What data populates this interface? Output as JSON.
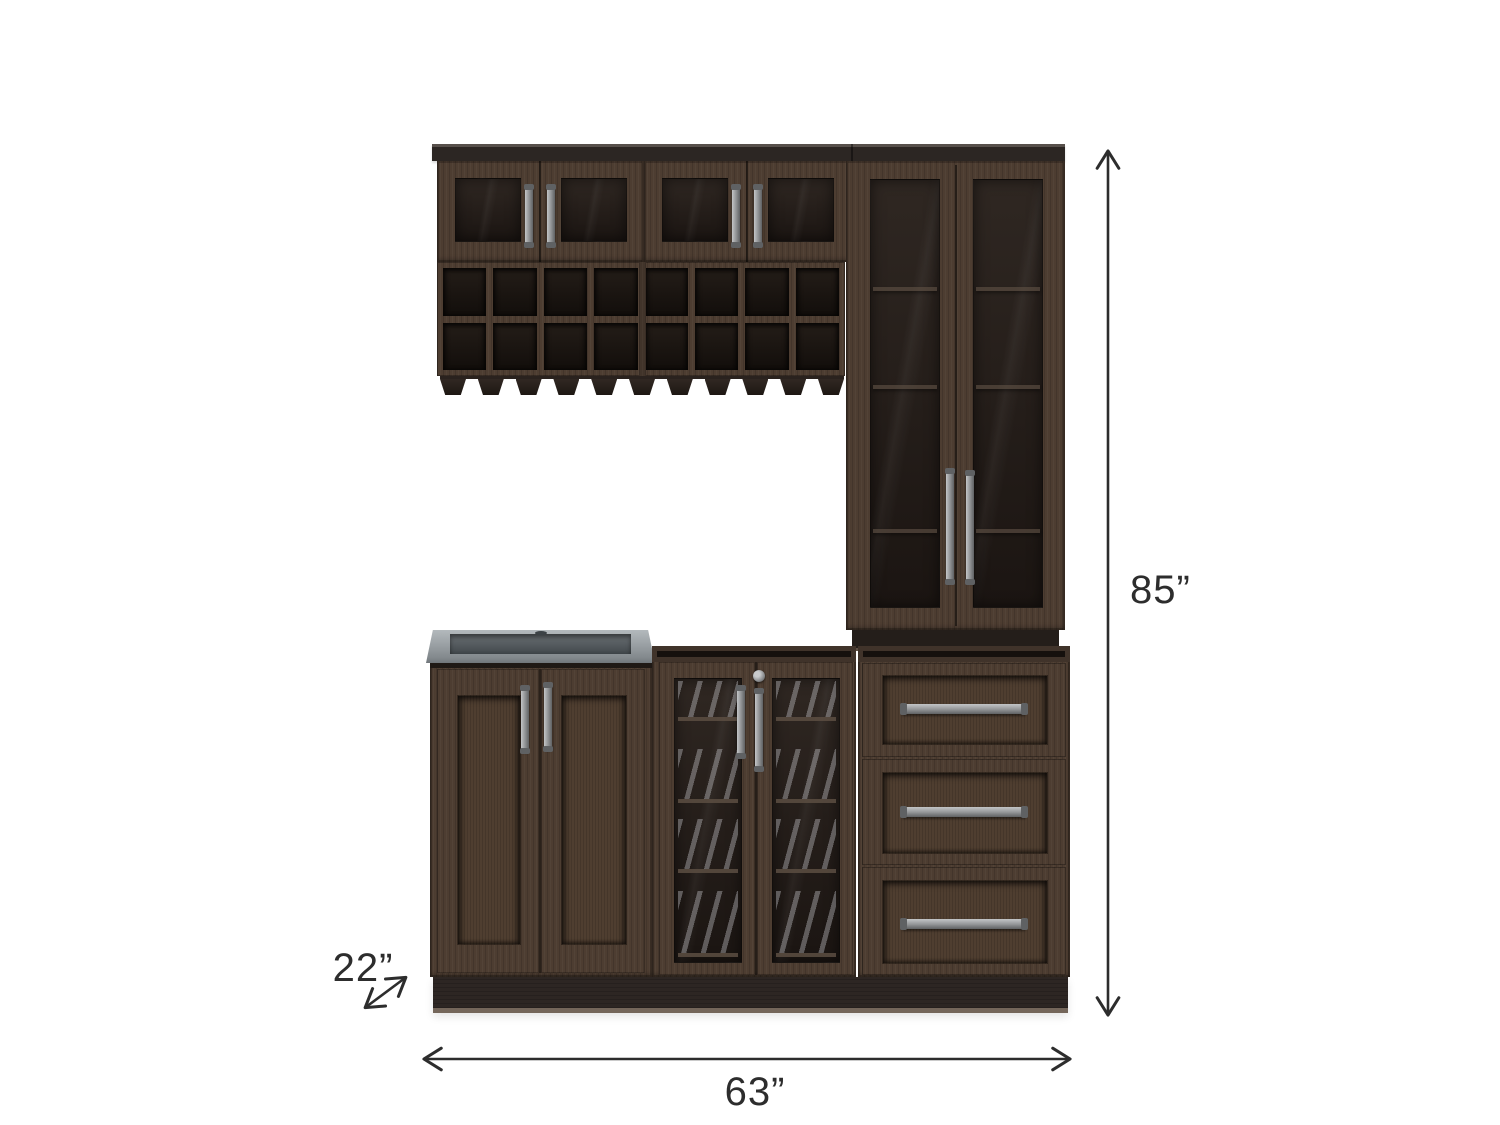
{
  "labels": {
    "height": "85”",
    "width": "63”",
    "depth": "22”"
  },
  "colors": {
    "bg": "#ffffff",
    "wood": "#4d3d31",
    "wood_dark": "#2d2623",
    "wood_deep": "#191310",
    "panel": "#4f3e30",
    "glass_top": "#2f2722",
    "glass_bot": "#1b1512",
    "shelf": "#5d4f43",
    "metal": "#97999b",
    "metal_light": "#c3c5c7",
    "metal_dark": "#5f6163",
    "sink_rim": "#a4aaae",
    "sink_basin": "#585e62",
    "ink": "#2d2d2d"
  }
}
